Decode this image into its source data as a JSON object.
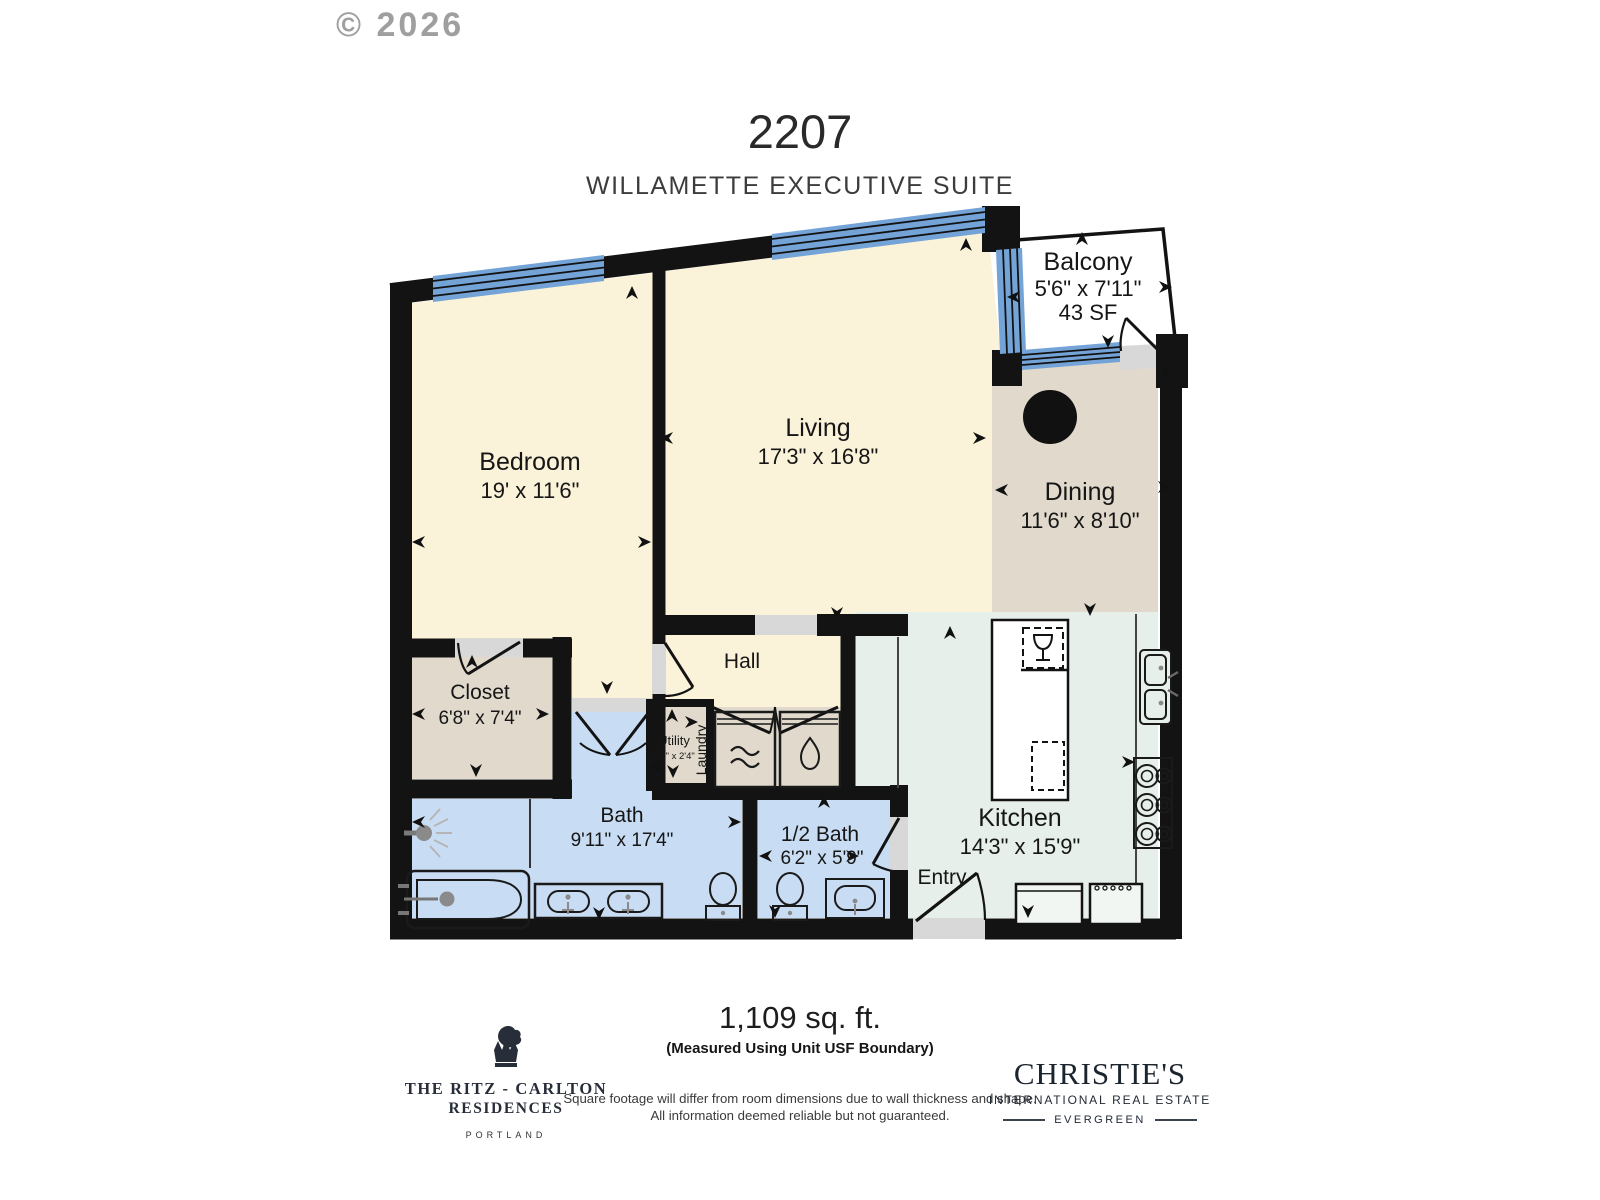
{
  "copyright": "© 2026",
  "header": {
    "unit_number": "2207",
    "unit_name": "WILLAMETTE EXECUTIVE SUITE"
  },
  "rooms": {
    "bedroom": {
      "name": "Bedroom",
      "dims": "19' x 11'6\""
    },
    "living": {
      "name": "Living",
      "dims": "17'3\" x 16'8\""
    },
    "dining": {
      "name": "Dining",
      "dims": "11'6\" x 8'10\""
    },
    "balcony": {
      "name": "Balcony",
      "dims": "5'6\" x 7'11\"",
      "area": "43 SF"
    },
    "kitchen": {
      "name": "Kitchen",
      "dims": "14'3\" x 15'9\""
    },
    "bath": {
      "name": "Bath",
      "dims": "9'11\" x 17'4\""
    },
    "half_bath": {
      "name": "1/2 Bath",
      "dims": "6'2\" x 5'9\""
    },
    "closet": {
      "name": "Closet",
      "dims": "6'8\" x 7'4\""
    },
    "utility": {
      "name": "Utility",
      "dims": "3'1\" x 2'4\""
    },
    "laundry": {
      "name": "Laundry"
    },
    "hall": {
      "name": "Hall"
    },
    "entry": {
      "name": "Entry"
    }
  },
  "footer": {
    "total_area": "1,109 sq. ft.",
    "measure_note": "(Measured Using Unit USF Boundary)",
    "disclaimer_line1": "Square footage will differ from room dimensions due to wall thickness and shape.",
    "disclaimer_line2": "All information deemed reliable but not guaranteed.",
    "ritz": {
      "brand_line1": "THE RITZ - CARLTON",
      "brand_line2": "RESIDENCES",
      "city": "PORTLAND"
    },
    "christies": {
      "brand": "CHRISTIE'S",
      "division": "INTERNATIONAL REAL ESTATE",
      "team": "EVERGREEN"
    }
  },
  "colors": {
    "wall": "#131313",
    "room_cream": "#FBF3D9",
    "room_tan": "#E0D9CC",
    "room_blue": "#C8DDF3",
    "room_mint": "#E6EFE9",
    "window_blue": "#74A3D7",
    "threshold_gray": "#D8D8D8"
  }
}
